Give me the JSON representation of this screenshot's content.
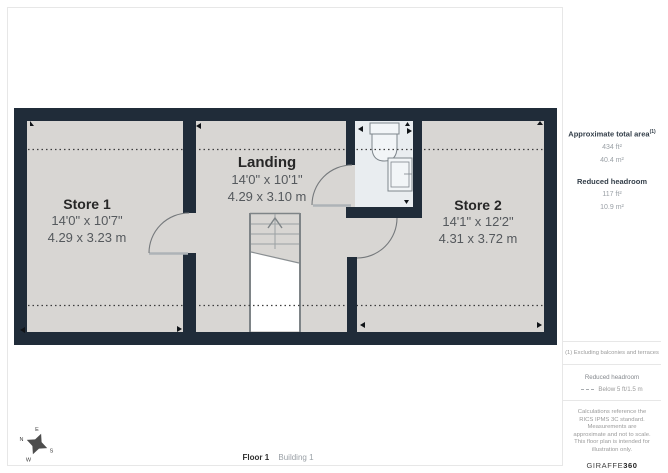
{
  "page": {
    "footer": {
      "floor_label": "Floor 1",
      "building_label": "Building 1"
    }
  },
  "plan": {
    "rooms": [
      {
        "name": "Store 1",
        "dims_imperial": "14'0\" x 10'7\"",
        "dims_metric": "4.29 x 3.23 m"
      },
      {
        "name": "Landing",
        "dims_imperial": "14'0\" x 10'1\"",
        "dims_metric": "4.29 x 3.10 m"
      },
      {
        "name": "Store 2",
        "dims_imperial": "14'1\" x 12'2\"",
        "dims_metric": "4.31 x 3.72 m"
      }
    ],
    "features": [
      "staircase-up",
      "bathroom",
      "reduced-headroom-dotted-lines",
      "doors"
    ],
    "compass": {
      "north": "N",
      "east": "E",
      "south": "S",
      "west": "W"
    }
  },
  "sidebar": {
    "total_area": {
      "label": "Approximate total area",
      "footnote_marker": "(1)",
      "value_imperial": "434 ft²",
      "value_metric": "40.4 m²"
    },
    "reduced_headroom": {
      "label": "Reduced headroom",
      "value_imperial": "117 ft²",
      "value_metric": "10.9 m²"
    },
    "footnote": "(1) Excluding balconies and terraces",
    "legend": {
      "label": "Reduced headroom",
      "value": "Below 5 ft/1.5 m"
    },
    "disclaimer": "Calculations reference the RICS IPMS 3C standard. Measurements are approximate and not to scale. This floor plan is intended for illustration only.",
    "brand": {
      "name": "GIRAFFE",
      "suffix": "360"
    }
  },
  "colors": {
    "wall": "#202c39",
    "floor": "#d8d6d3",
    "wet_room_floor": "#e9edf0",
    "reduced_headroom_line": "#3c3c3c",
    "divider": "#e7e7e7"
  }
}
